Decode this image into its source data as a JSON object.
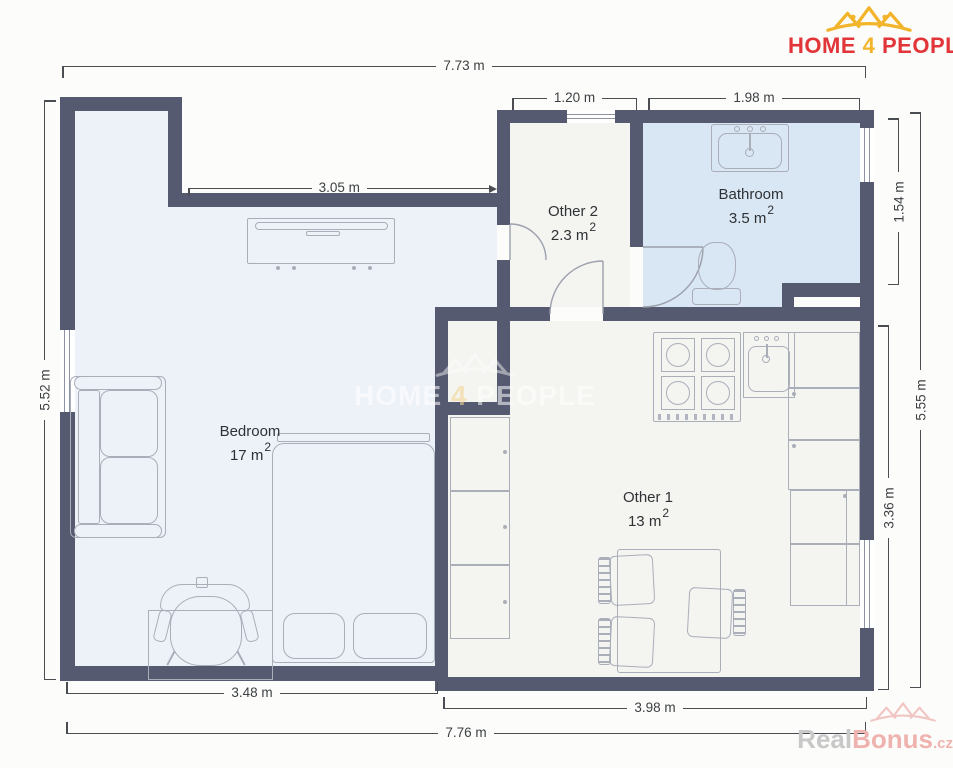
{
  "brand": {
    "home": "HOME",
    "four": "4",
    "people": "PEOPLE"
  },
  "rooms": [
    {
      "label": "Bedroom",
      "area": "17 m",
      "sup": "2"
    },
    {
      "label": "Other 2",
      "area": "2.3 m",
      "sup": "2"
    },
    {
      "label": "Bathroom",
      "area": "3.5 m",
      "sup": "2"
    },
    {
      "label": "Other 1",
      "area": "13 m",
      "sup": "2"
    }
  ],
  "dimensions": {
    "top_total": "7.73 m",
    "other2_top_width": "1.20 m",
    "bathroom_top_width": "1.98 m",
    "bedroom_upper_width": "3.05 m",
    "left_height": "5.52 m",
    "bathroom_right_height": "1.54 m",
    "right_height": "5.55 m",
    "other1_right_height": "3.36 m",
    "bedroom_bottom_width": "3.48 m",
    "other1_bottom_width": "3.98 m",
    "bottom_total": "7.76 m"
  },
  "watermarks": {
    "center_home": "HOME",
    "center_four": "4",
    "center_people": "PEOPLE",
    "corner_real": "Real",
    "corner_bonus": "Bonus",
    "corner_cz": ".cz"
  },
  "colors": {
    "wall": "#565a70",
    "bedroom_floor": "#edf1f8",
    "bathroom_floor": "#d9e6f3",
    "other_floor": "#f4f4f1",
    "dimension_line": "#4a4d52",
    "furniture_outline": "#a9aeb9",
    "brand_red": "#e23539",
    "brand_gold": "#f2b42a",
    "watermark_gray": "#c8c8c8",
    "watermark_pink": "#efb3af"
  }
}
